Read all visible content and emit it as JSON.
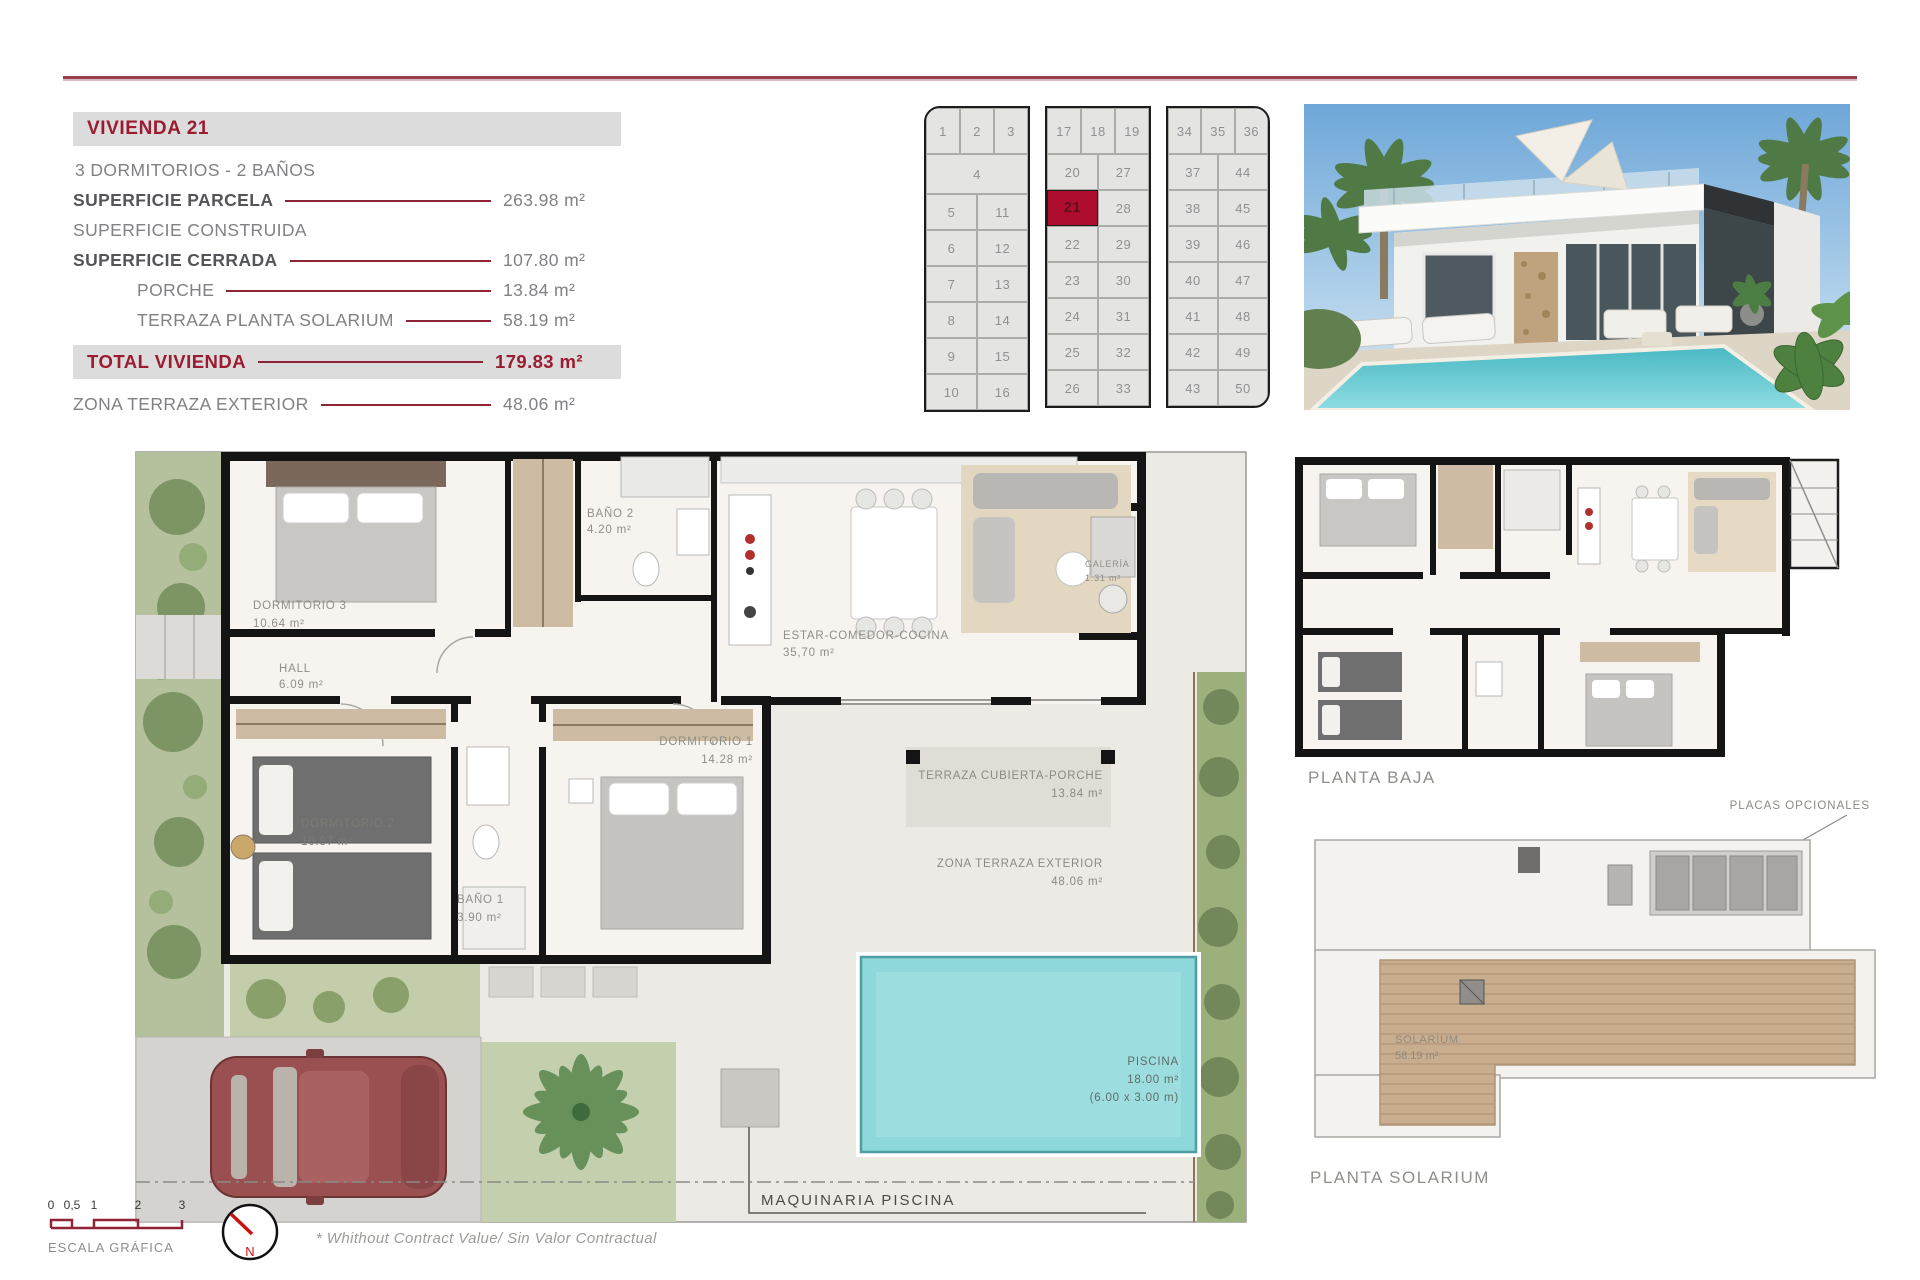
{
  "colors": {
    "accent": "#9b1b31",
    "rule_line": "#8e2436",
    "band_gray": "#dcdcdc",
    "highlight_cell": "#ae0d30",
    "pool": "#7fd4d8"
  },
  "info_panel": {
    "title": "VIVIENDA 21",
    "subtitle": "3 DORMITORIOS - 2 BAÑOS",
    "rows": [
      {
        "label": "SUPERFICIE PARCELA",
        "value": "263.98 m²"
      },
      {
        "label": "SUPERFICIE CONSTRUIDA",
        "value": ""
      },
      {
        "label": "SUPERFICIE CERRADA",
        "value": "107.80 m²"
      },
      {
        "label": "PORCHE",
        "value": "13.84 m²"
      },
      {
        "label": "TERRAZA PLANTA SOLARIUM",
        "value": "58.19 m²"
      }
    ],
    "total": {
      "label": "TOTAL VIVIENDA",
      "value": "179.83 m²"
    },
    "extra": {
      "label": "ZONA TERRAZA EXTERIOR",
      "value": "48.06 m²"
    }
  },
  "site_map": {
    "highlight": "21",
    "blocks": [
      {
        "header": [
          "1",
          "2",
          "3"
        ],
        "wide": "4",
        "rows": [
          [
            "5",
            "11"
          ],
          [
            "6",
            "12"
          ],
          [
            "7",
            "13"
          ],
          [
            "8",
            "14"
          ],
          [
            "9",
            "15"
          ],
          [
            "10",
            "16"
          ]
        ]
      },
      {
        "header": [
          "17",
          "18",
          "19"
        ],
        "rows": [
          [
            "20",
            "27"
          ],
          [
            "21",
            "28"
          ],
          [
            "22",
            "29"
          ],
          [
            "23",
            "30"
          ],
          [
            "24",
            "31"
          ],
          [
            "25",
            "32"
          ],
          [
            "26",
            "33"
          ]
        ]
      },
      {
        "header": [
          "34",
          "35",
          "36"
        ],
        "rows": [
          [
            "37",
            "44"
          ],
          [
            "38",
            "45"
          ],
          [
            "39",
            "46"
          ],
          [
            "40",
            "47"
          ],
          [
            "41",
            "48"
          ],
          [
            "42",
            "49"
          ],
          [
            "43",
            "50"
          ]
        ]
      }
    ]
  },
  "floor_plan": {
    "rooms": [
      {
        "name": "DORMITORIO 3",
        "area": "10.64 m²"
      },
      {
        "name": "BAÑO 2",
        "area": "4.20 m²"
      },
      {
        "name": "HALL",
        "area": "6.09 m²"
      },
      {
        "name": "ESTAR-COMEDOR-COCINA",
        "area": "35,70 m²"
      },
      {
        "name": "GALERÍA",
        "area": "1.31 m²"
      },
      {
        "name": "DORMITORIO 1",
        "area": "14.28 m²"
      },
      {
        "name": "DORMITORIO 2",
        "area": "10.87 m²"
      },
      {
        "name": "BAÑO 1",
        "area": "3.90 m²"
      },
      {
        "name": "TERRAZA CUBIERTA-PORCHE",
        "area": "13.84 m²"
      },
      {
        "name": "ZONA TERRAZA EXTERIOR",
        "area": "48.06 m²"
      },
      {
        "name": "PISCINA",
        "area": "18.00 m²",
        "dims": "(6.00 x 3.00 m)"
      }
    ],
    "machine_label": "MAQUINARIA PISCINA"
  },
  "secondary": {
    "planta_baja_label": "PLANTA BAJA",
    "planta_solarium_label": "PLANTA SOLARIUM",
    "solarium": {
      "name": "SOLARIUM",
      "area": "58.19 m²"
    },
    "placas_label": "PLACAS OPCIONALES"
  },
  "footer": {
    "scale_ticks": [
      "0",
      "0,5",
      "1",
      "2",
      "3"
    ],
    "scale_label": "ESCALA GRÁFICA",
    "north": "N",
    "disclaimer": "*  Whithout Contract Value/ Sin Valor Contractual"
  }
}
